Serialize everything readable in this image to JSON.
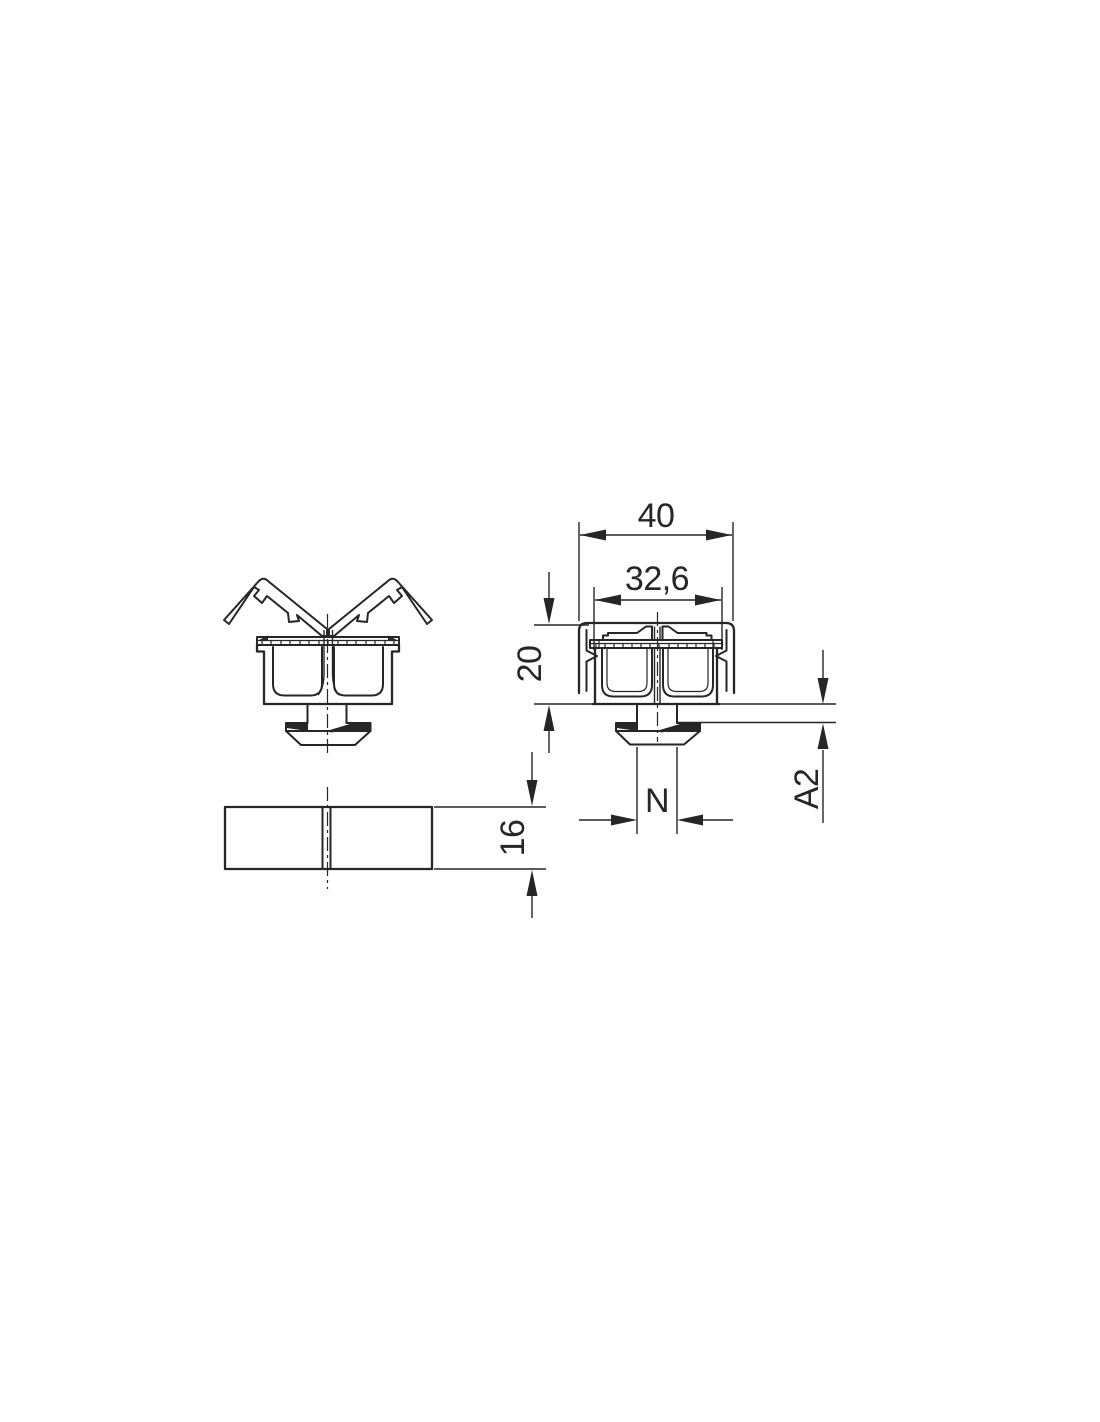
{
  "page": {
    "background": "#ffffff",
    "line_color": "#262626"
  },
  "dimensions": {
    "overall_width": "40",
    "inner_width": "32,6",
    "body_height": "20",
    "slot_width": "N",
    "flange_height": "A2",
    "plate_thickness": "16"
  }
}
